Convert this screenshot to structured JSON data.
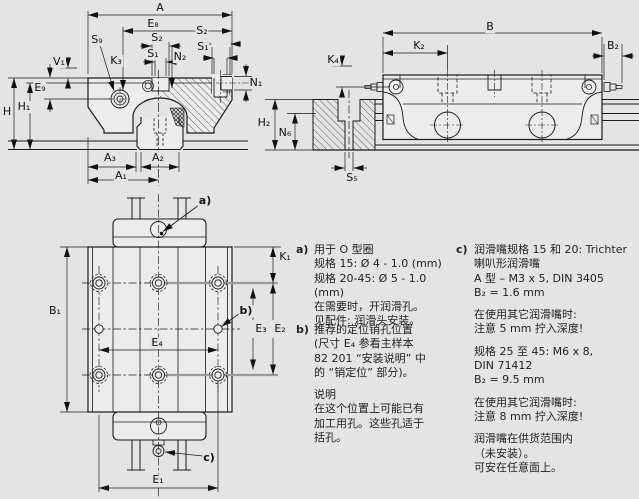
{
  "colors": {
    "background": "#e4e4e4",
    "line": "#1a1a1a",
    "accent_gray": "#9a9a9a"
  },
  "dims": {
    "A": "A",
    "E8": "E₈",
    "S2": "S₂",
    "S1": "S₁",
    "S9": "S₉",
    "K3": "K₃",
    "N2": "N₂",
    "V1": "V₁",
    "E9": "E₉",
    "H": "H",
    "H1": "H₁",
    "N1": "N₁",
    "A3": "A₃",
    "A2": "A₂",
    "A1": "A₁",
    "B": "B",
    "K2": "K₂",
    "B2": "B₂",
    "K4": "K₄",
    "H2": "H₂",
    "N6": "N₆",
    "S5": "S₅",
    "K1": "K₁",
    "B1": "B₁",
    "E1": "E₁",
    "E2": "E₂",
    "E3": "E₃",
    "E4": "E₄",
    "a": "a)",
    "b": "b)",
    "c": "c)"
  },
  "notes": {
    "a": {
      "label": "a)",
      "lines": [
        "用于 O 型圈",
        "规格 15: Ø 4 - 1.0 (mm)",
        "规格 20-45: Ø 5 - 1.0 (mm)",
        "在需要时，开润滑孔。",
        "见配件: 润滑头安装。"
      ]
    },
    "b": {
      "label": "b)",
      "para1": [
        "推荐的定位销孔位置",
        "(尺寸 E₄ 参看主样本",
        "82 201 “安装说明” 中",
        "的 “销定位” 部分)。"
      ],
      "para2": [
        "说明",
        "在这个位置上可能已有",
        "加工用孔。这些孔适于",
        "括孔。"
      ]
    },
    "c": {
      "label": "c)",
      "para1": [
        "润滑嘴规格 15 和 20: Trichter",
        "喇叭形润滑嘴",
        "A 型 – M3 x 5, DIN 3405",
        "B₂ = 1.6 mm"
      ],
      "para2": [
        "在使用其它润滑嘴时:",
        "注意 5 mm 拧入深度!"
      ],
      "para3": [
        "规格 25 至 45: M6 x 8,",
        "DIN 71412",
        "B₂ = 9.5 mm"
      ],
      "para4": [
        "在使用其它润滑嘴时:",
        "注意 8 mm 拧入深度!"
      ],
      "para5": [
        "润滑嘴在供货范围内",
        "（未安装）。",
        "可安在任意面上。"
      ]
    }
  }
}
